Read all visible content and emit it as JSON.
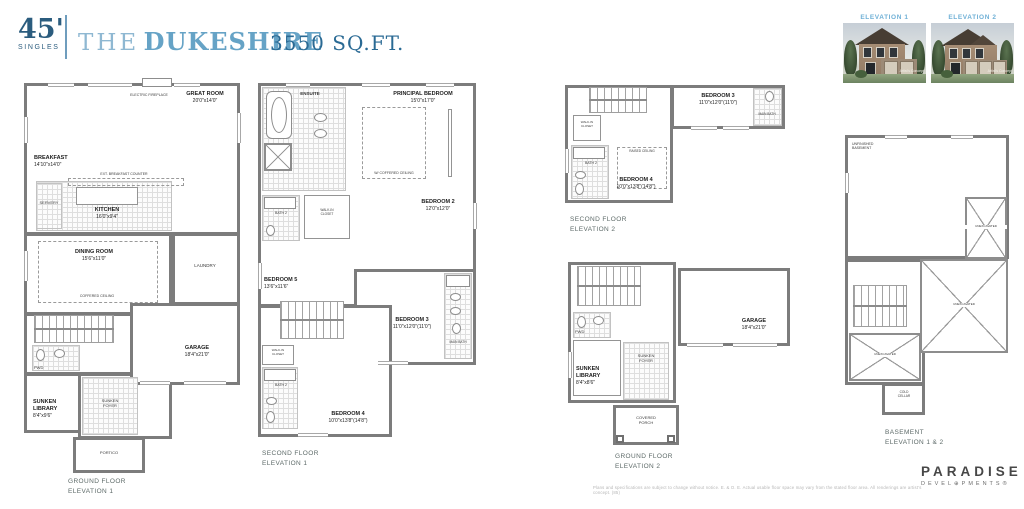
{
  "header": {
    "lot_size": "45'",
    "lot_type": "SINGLES",
    "model_prefix": "THE",
    "model_name": "DUKESHIRE",
    "sqft": "3550 SQ.FT."
  },
  "elevations": {
    "elevation1_label": "ELEVATION 1",
    "elevation2_label": "ELEVATION 2",
    "watermark": "Artist's Concept"
  },
  "plans": {
    "gf1": {
      "caption": "GROUND FLOOR\nELEVATION 1",
      "great_room": {
        "name": "GREAT ROOM",
        "dims": "20'0\"x14'0\""
      },
      "fireplace": "ELECTRIC FIREPLACE",
      "breakfast": {
        "name": "BREAKFAST",
        "dims": "14'10\"x14'0\""
      },
      "kitchen": {
        "name": "KITCHEN",
        "dims": "16'0\"x9'4\""
      },
      "counter_note": "EXT. BREAKFAST COUNTER",
      "servery": "SERVERY",
      "dining": {
        "name": "DINING ROOM",
        "dims": "15'6\"x11'0\""
      },
      "dining_note": "COFFERED CEILING",
      "laundry": "LAUNDRY",
      "pwd": "PWD",
      "library": {
        "name": "SUNKEN\nLIBRARY",
        "dims": "8'4\"x9'6\""
      },
      "foyer": "SUNKEN\nFOYER",
      "portico": "PORTICO",
      "garage": {
        "name": "GARAGE",
        "dims": "18'4\"x21'0\""
      }
    },
    "sf1": {
      "caption": "SECOND FLOOR\nELEVATION 1",
      "ensuite": "ENSUITE",
      "principal": {
        "name": "PRINCIPAL BEDROOM",
        "dims": "15'0\"x17'0\""
      },
      "principal_note": "W/ COFFERED CEILING",
      "bedroom2": {
        "name": "BEDROOM 2",
        "dims": "12'0\"x12'0\""
      },
      "bedroom3": {
        "name": "BEDROOM 3",
        "dims": "11'0\"x12'0\"(11'0\")"
      },
      "bedroom4": {
        "name": "BEDROOM 4",
        "dims": "10'0\"x13'8\"(14'8\")"
      },
      "bedroom5": {
        "name": "BEDROOM 5",
        "dims": "13'6\"x11'6\""
      },
      "bath2": "BATH 2",
      "main_bath": "MAIN BATH",
      "wic": "WALK-IN\nCLOSET"
    },
    "sf2": {
      "caption": "SECOND FLOOR\nELEVATION 2",
      "bedroom3": {
        "name": "BEDROOM 3",
        "dims": "11'0\"x12'0\"(11'0\")"
      },
      "bedroom4": {
        "name": "BEDROOM 4",
        "dims": "10'0\"x13'8\"(14'8\")"
      },
      "bath2": "BATH 2",
      "main_bath": "MAIN BATH",
      "wic": "WALK-IN\nCLOSET",
      "raised_note": "RAISED CEILING"
    },
    "gf2": {
      "caption": "GROUND FLOOR\nELEVATION 2",
      "pwd": "PWD",
      "library": {
        "name": "SUNKEN\nLIBRARY",
        "dims": "8'4\"x8'6\""
      },
      "foyer": "SUNKEN\nFOYER",
      "porch": "COVERED\nPORCH",
      "garage": {
        "name": "GARAGE",
        "dims": "18'4\"x21'0\""
      }
    },
    "basement": {
      "caption": "BASEMENT\nELEVATION 1 & 2",
      "unfinished": "UNFINISHED\nBASEMENT",
      "unexcavated": "UNEXCAVATED",
      "cold_cellar": "COLD\nCELLAR"
    }
  },
  "footer": {
    "disclaimer": "Plans and specifications are subject to change without notice. E. & O. E.  Actual usable floor space may vary from the stated floor area. All renderings are artist's concept. (85)",
    "brand_name": "PARADISE",
    "brand_sub": "DEVEL⊕PMENTS®"
  },
  "colors": {
    "accent_dark": "#2b5c7e",
    "accent_light": "#66a3c6",
    "elevation_label_blue": "#6fb0d6",
    "wall_gray": "#7c7c7c"
  }
}
